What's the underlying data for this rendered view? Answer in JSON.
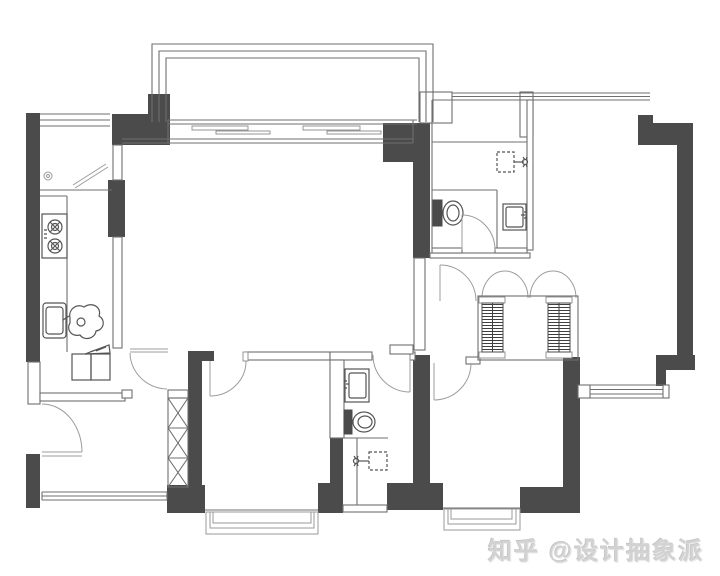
{
  "watermark": {
    "platform": "知乎",
    "handle": "@设计抽象派",
    "text": "知乎 @设计抽象派"
  },
  "colors": {
    "background": "#ffffff",
    "wall_fill": "#4b4b4b",
    "thin_wall_line": "#6f6f6f",
    "door_arc_line": "#9c9c9c",
    "fixture_line": "#555555",
    "watermark_text": "#d2d2d2"
  },
  "legend": {
    "drawing_type": "apartment floor plan",
    "fixtures": [
      "gas-stove",
      "kitchen-sink",
      "refrigerator",
      "floor-drain",
      "folding-door",
      "toilet",
      "wash-basin",
      "shower-head",
      "wardrobe",
      "vent-shaft",
      "hinged-door",
      "sliding-door",
      "bay-window",
      "window",
      "balcony-railing",
      "decor-figure"
    ]
  }
}
